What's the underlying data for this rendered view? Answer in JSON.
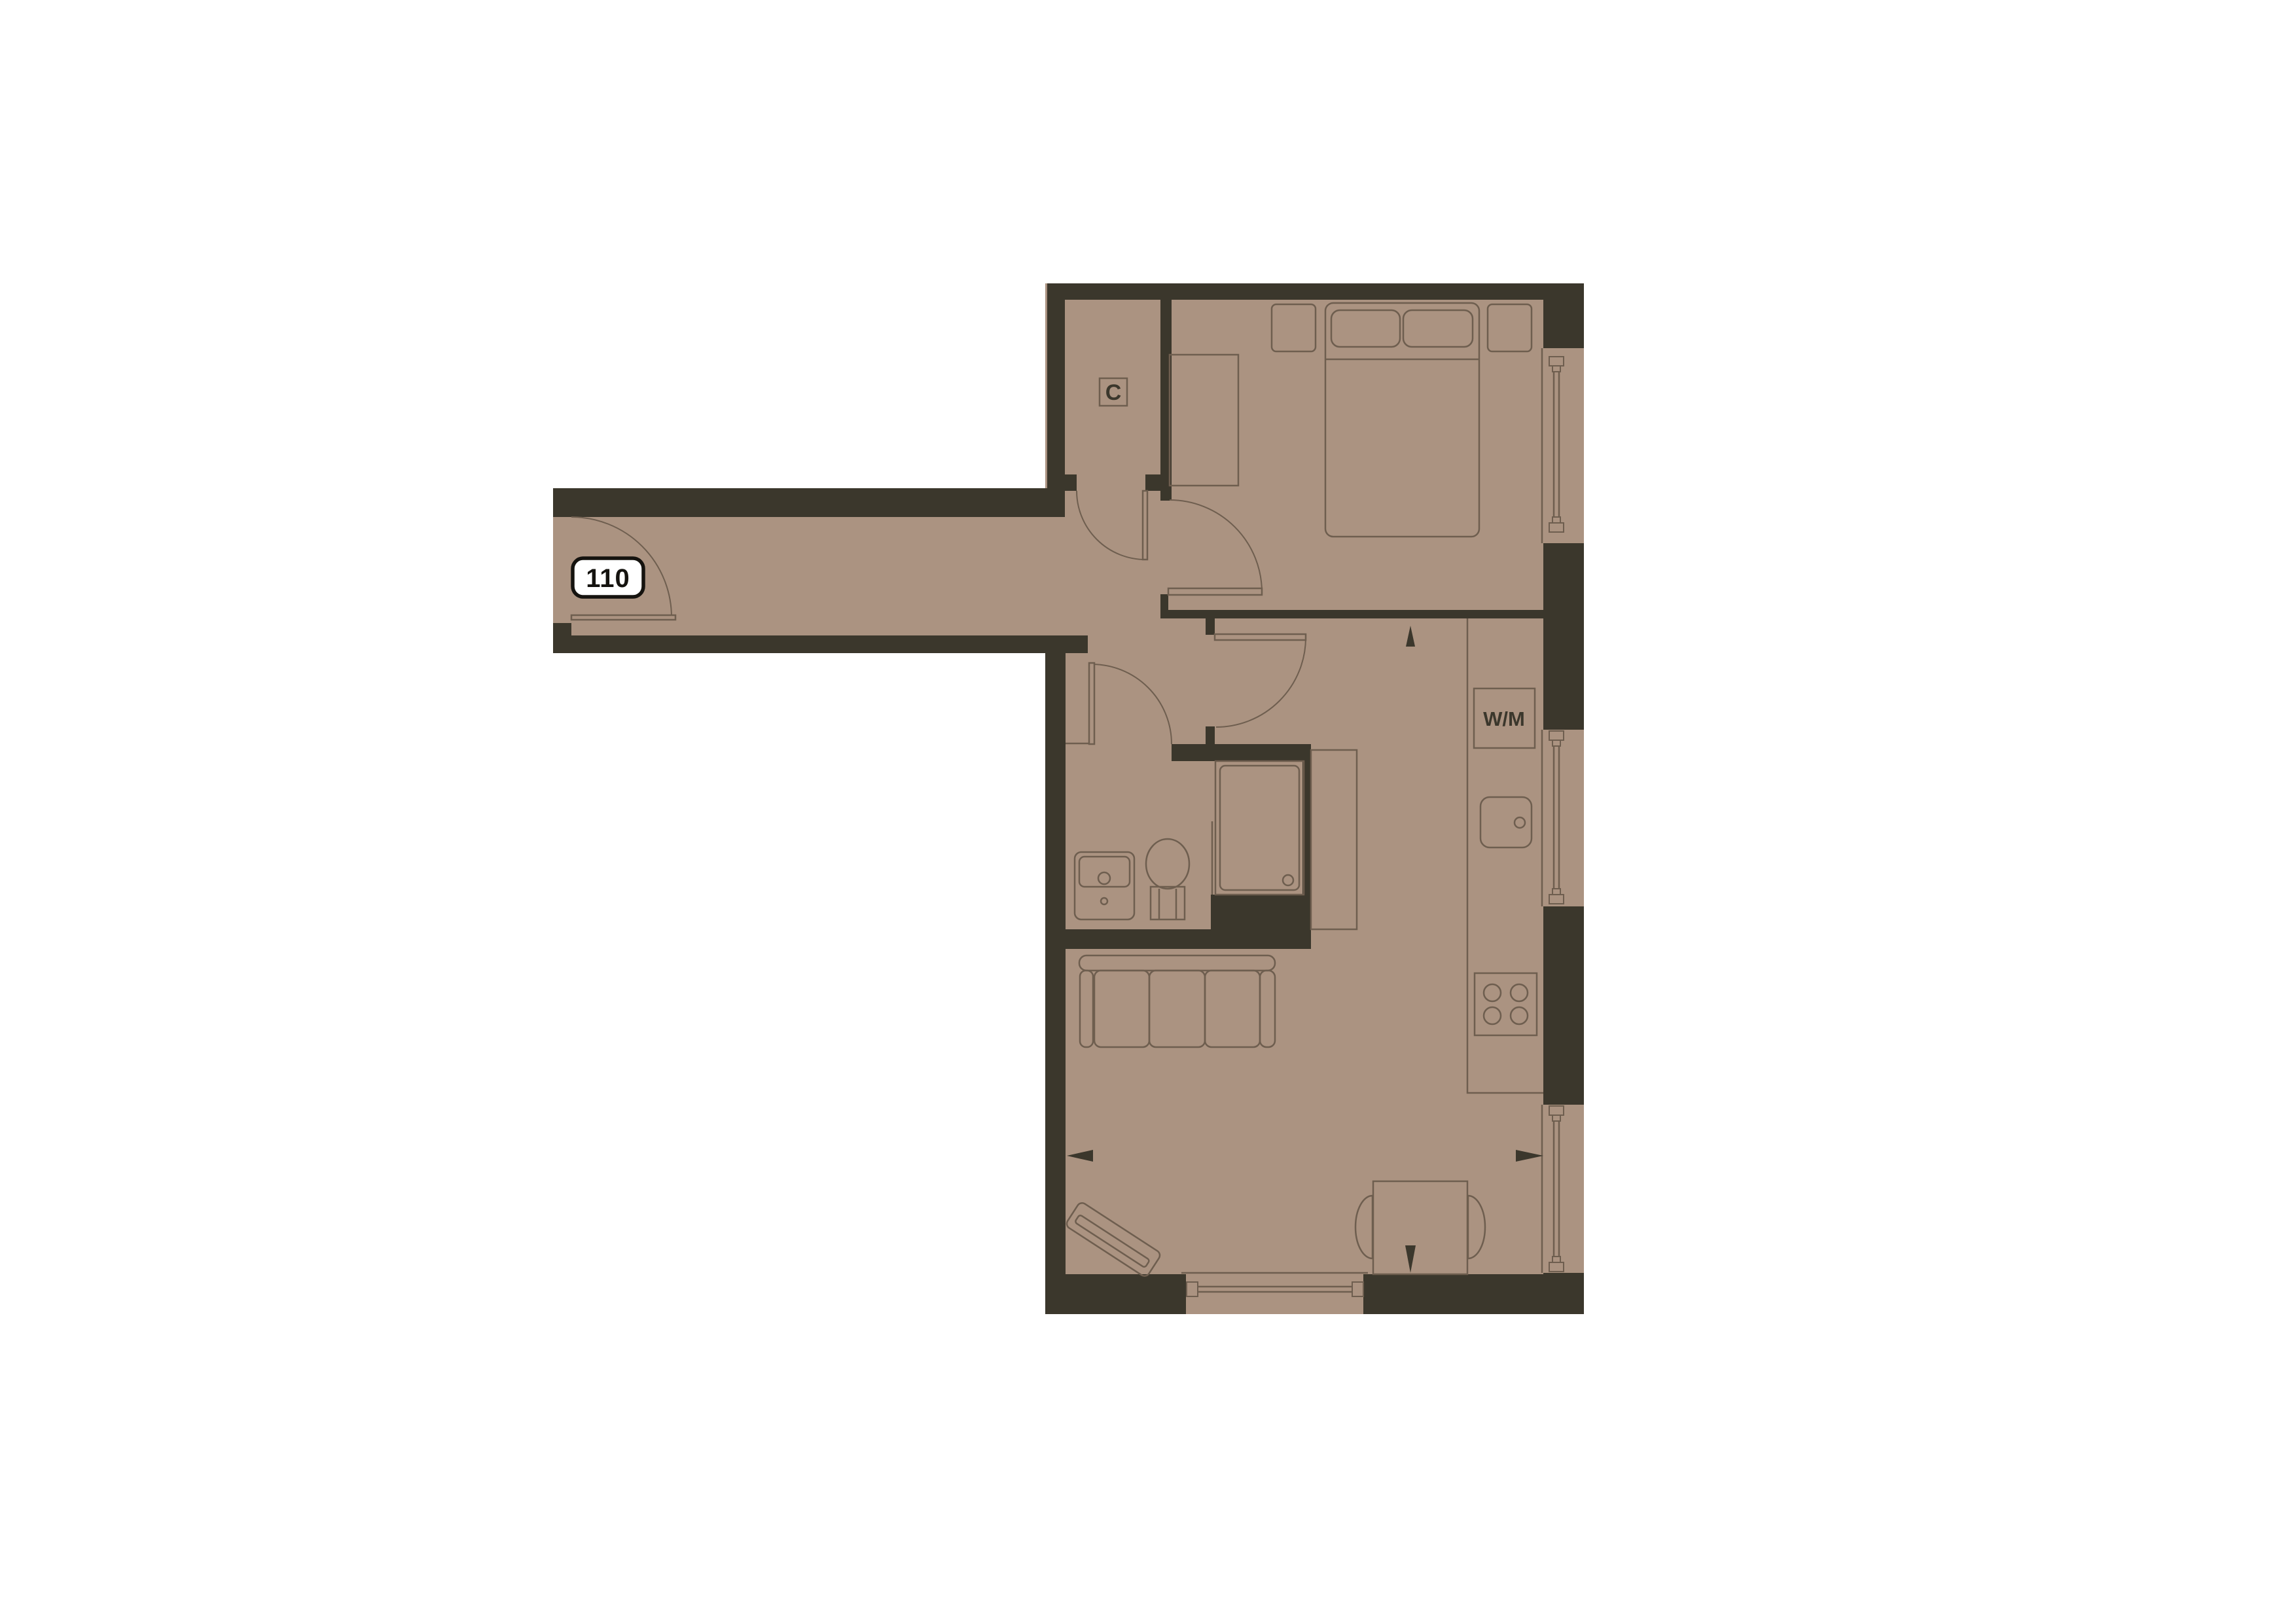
{
  "plan": {
    "unit_badge": "110",
    "labels": {
      "cupboard": "C",
      "washing_machine": "W/M"
    },
    "colors": {
      "background": "#ffffff",
      "wall": "#3b372c",
      "floor": "#ab9381",
      "line": "#6e5e4f",
      "text": "#3b372c",
      "badge_bg": "#ffffff",
      "badge_border": "#15130f",
      "badge_text": "#15130f"
    }
  }
}
